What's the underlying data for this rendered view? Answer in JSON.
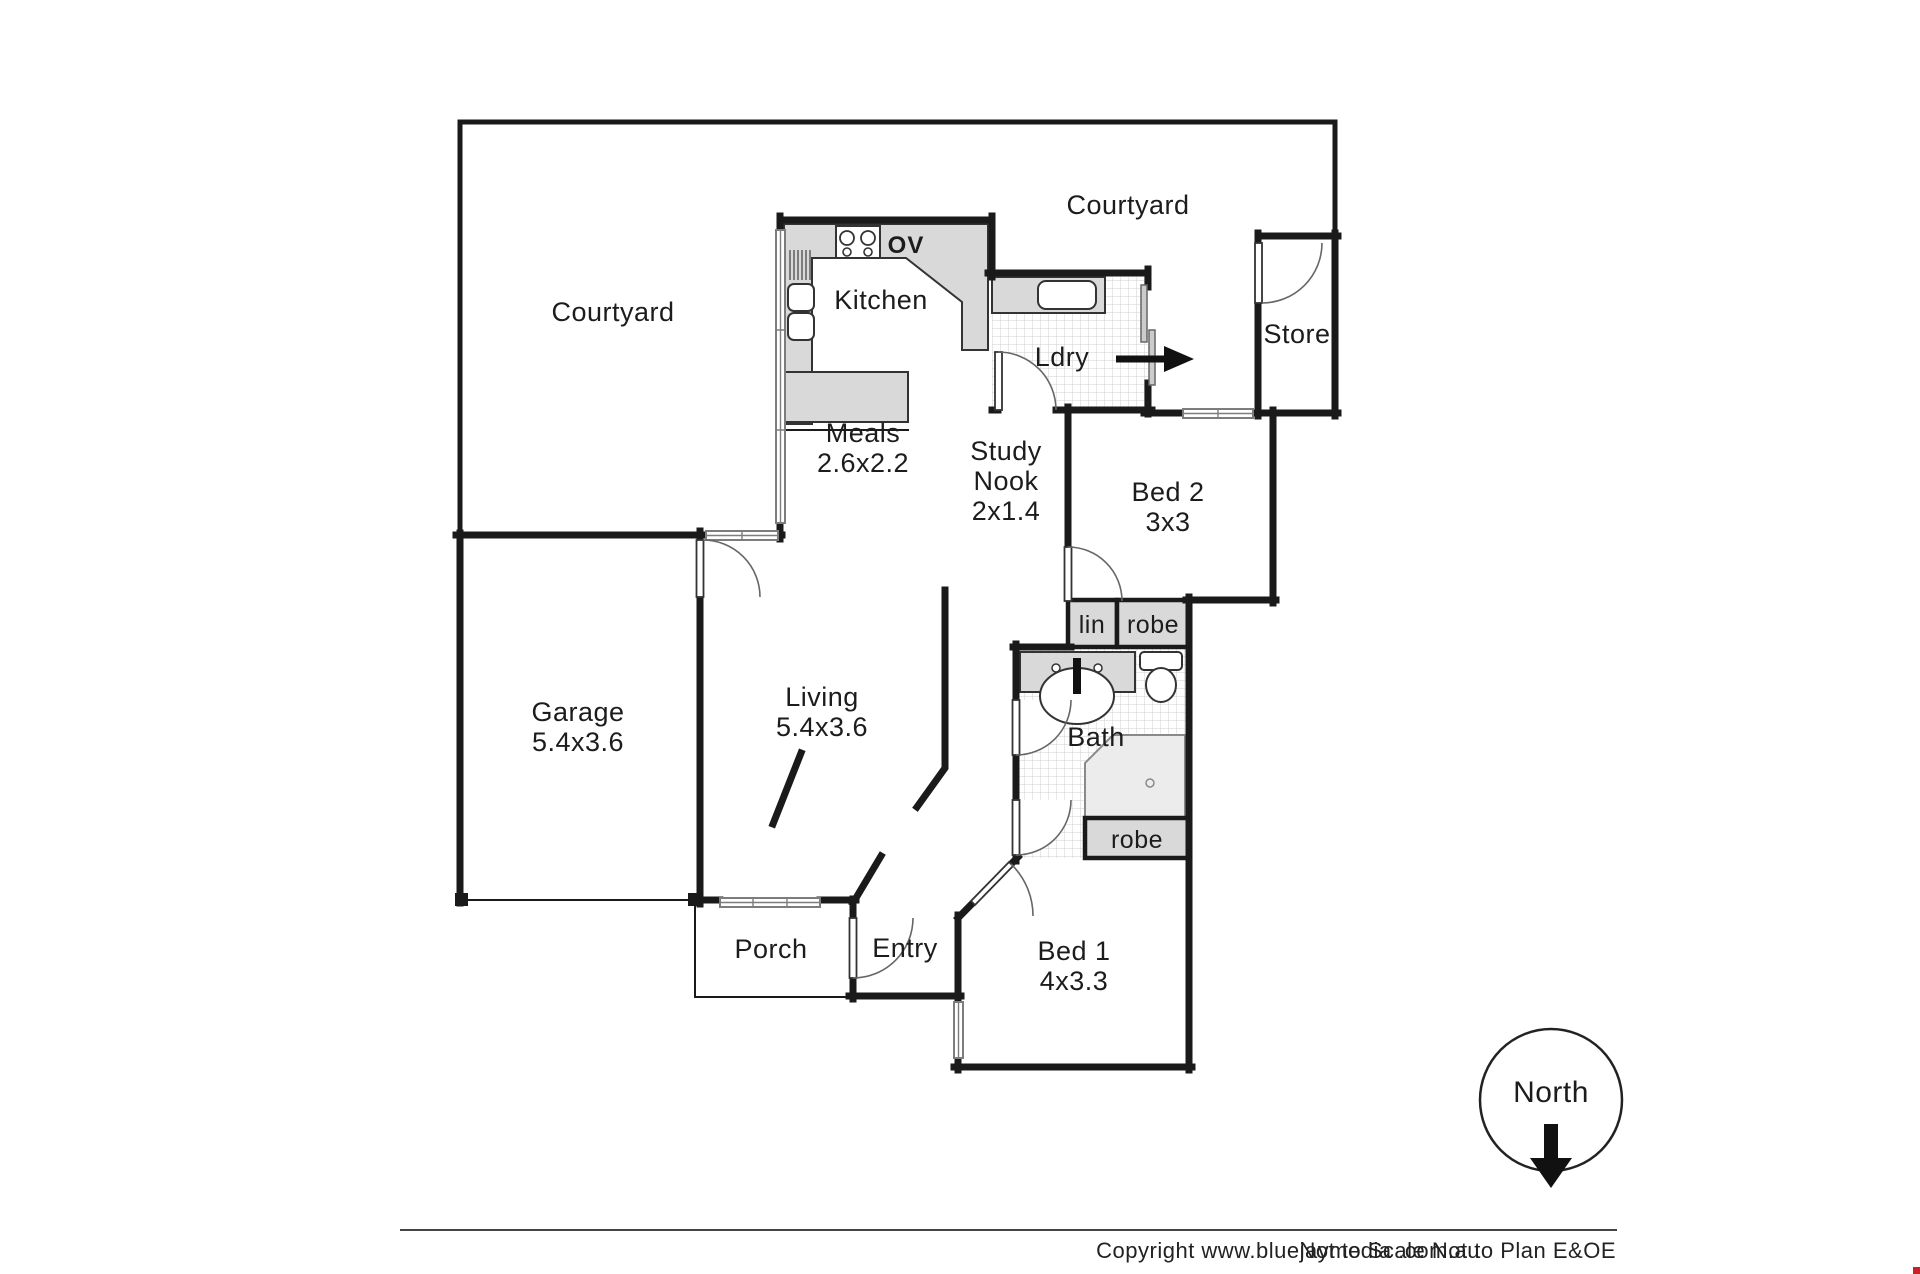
{
  "colors": {
    "wall": "#1a1a1a",
    "bench_grey": "#d9d9d9",
    "tile_line": "#cfcfcf",
    "accent_red": "#cb2026"
  },
  "labels": {
    "courtyard_left": "Courtyard",
    "courtyard_right": "Courtyard",
    "kitchen": "Kitchen",
    "oven": "OV",
    "laundry": "Ldry",
    "store": "Store",
    "meals": {
      "name": "Meals",
      "dim": "2.6x2.2"
    },
    "study_nook": {
      "line1": "Study",
      "line2": "Nook",
      "dim": "2x1.4"
    },
    "bed2": {
      "name": "Bed 2",
      "dim": "3x3"
    },
    "linen": "lin",
    "robe_hall": "robe",
    "garage": {
      "name": "Garage",
      "dim": "5.4x3.6"
    },
    "living": {
      "name": "Living",
      "dim": "5.4x3.6"
    },
    "bath": "Bath",
    "robe_bed1": "robe",
    "porch": "Porch",
    "entry": "Entry",
    "bed1": {
      "name": "Bed 1",
      "dim": "4x3.3"
    },
    "compass": "North",
    "footer": {
      "copyright": "Copyright www.bluejaymedia .com.au",
      "disclaimer": "Not to Scale Not to Plan E&OE"
    }
  }
}
